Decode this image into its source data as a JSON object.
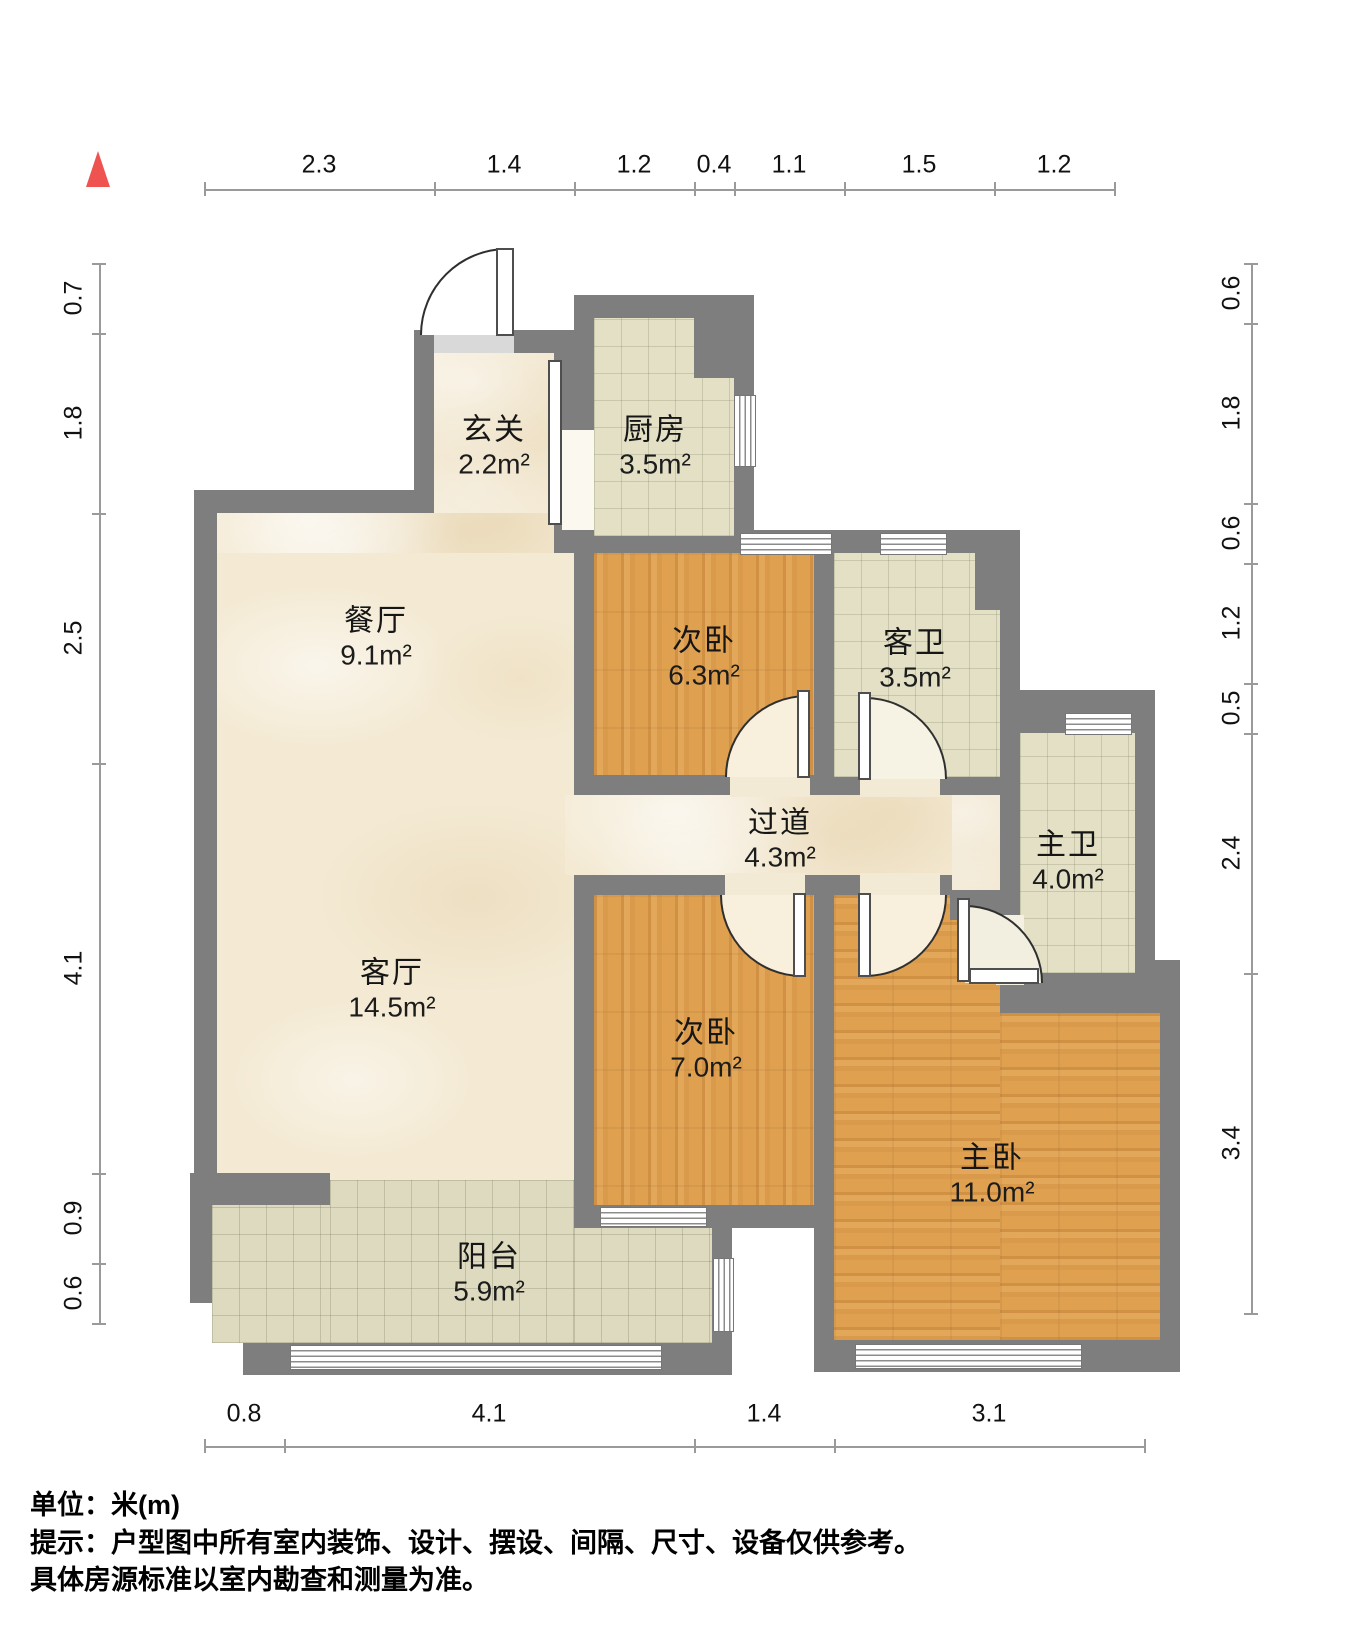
{
  "title": "户型图",
  "compass": {
    "icon": "north-arrow-icon",
    "color": "#ef5350"
  },
  "dims": {
    "top": {
      "values": [
        "2.3",
        "1.4",
        "1.2",
        "0.4",
        "1.1",
        "1.5",
        "1.2"
      ]
    },
    "left": {
      "values": [
        "0.7",
        "1.8",
        "2.5",
        "4.1",
        "0.9",
        "0.6"
      ]
    },
    "right": {
      "values": [
        "0.6",
        "1.8",
        "0.6",
        "1.2",
        "0.5",
        "2.4",
        "3.4"
      ]
    },
    "bottom": {
      "values": [
        "0.8",
        "4.1",
        "1.4",
        "3.1"
      ]
    }
  },
  "rooms": [
    {
      "name": "玄关",
      "area": "2.2m²"
    },
    {
      "name": "厨房",
      "area": "3.5m²"
    },
    {
      "name": "餐厅",
      "area": "9.1m²"
    },
    {
      "name": "次卧",
      "area": "6.3m²"
    },
    {
      "name": "客卫",
      "area": "3.5m²"
    },
    {
      "name": "过道",
      "area": "4.3m²"
    },
    {
      "name": "主卫",
      "area": "4.0m²"
    },
    {
      "name": "客厅",
      "area": "14.5m²"
    },
    {
      "name": "次卧",
      "area": "7.0m²"
    },
    {
      "name": "主卧",
      "area": "11.0m²"
    },
    {
      "name": "阳台",
      "area": "5.9m²"
    }
  ],
  "footer": {
    "unit_line": "单位：米(m)",
    "notice_line1": "提示：户型图中所有室内装饰、设计、摆设、间隔、尺寸、设备仅供参考。",
    "notice_line2": "具体房源标准以室内勘查和测量为准。"
  },
  "colors": {
    "wall": "#7e7e7e",
    "wood_floor": "#dfa04f",
    "tile_floor": "#e3e0c6",
    "balcony_tile": "#dddac0",
    "marble_floor": "#f4ead4",
    "accent_red": "#ef5350",
    "dim_line": "#9a9a9a",
    "text": "#111111"
  }
}
